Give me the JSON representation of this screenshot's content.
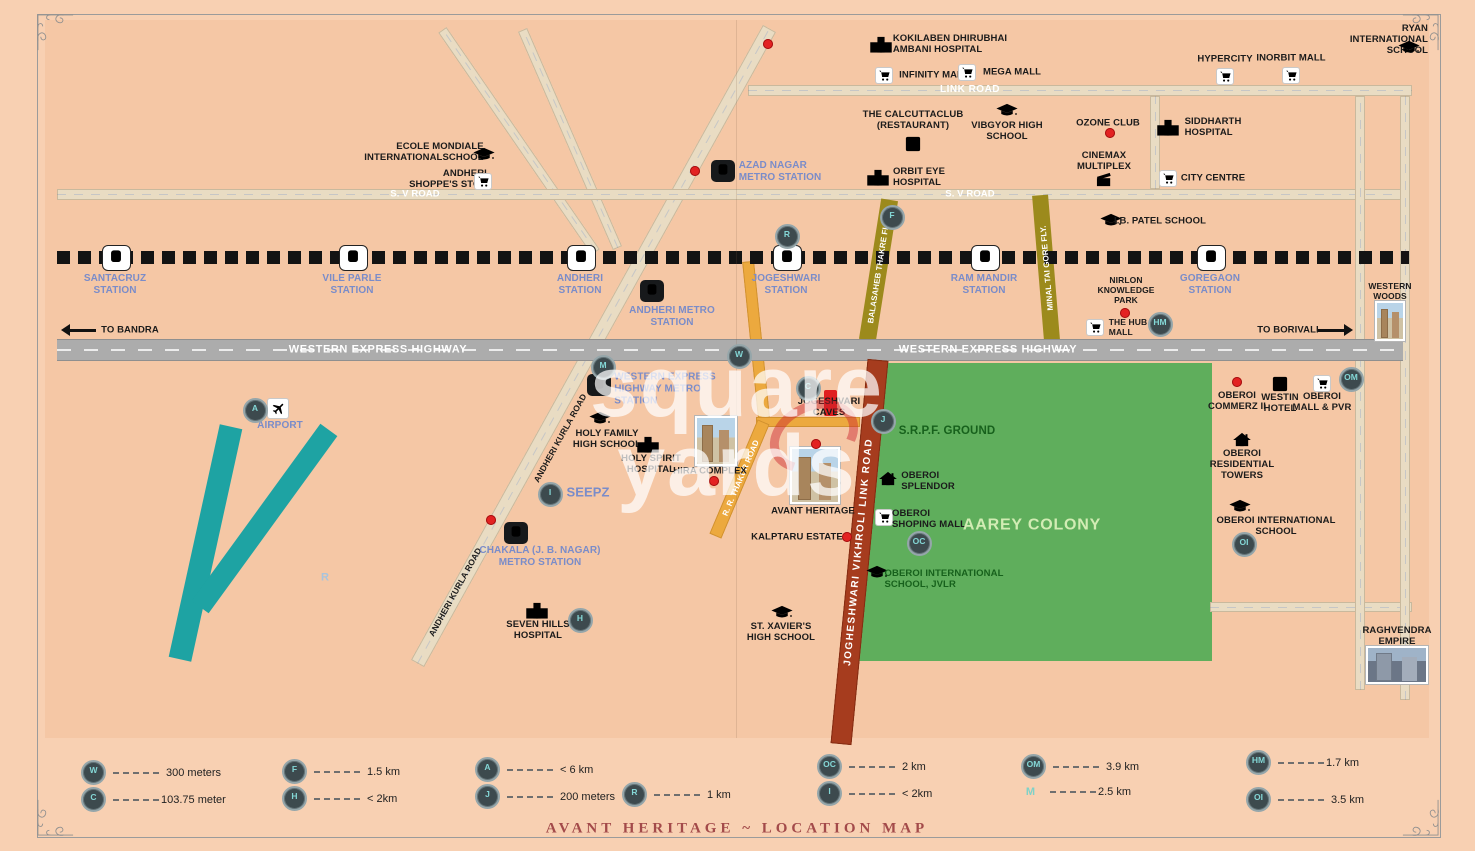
{
  "title": "AVANT HERITAGE ~ LOCATION MAP",
  "watermark": {
    "line1": "square",
    "line2": "yards"
  },
  "roads": {
    "link_road": "LINK ROAD",
    "sv_road_left": "S. V ROAD",
    "sv_road_right": "S. V ROAD",
    "weh_left": "WESTERN EXPRESS HIGHWAY",
    "weh_right": "WESTERN EXPRESS HIGHWAY",
    "balasaheb_fly": "BALASAHEB THAKRE FLY.",
    "minal_fly": "MINAL TAI GORE FLY.",
    "jvlr": "JOGHESHWARI VIKHROLI LINK ROAD",
    "rr_thakur": "R. R. THAKUR ROAD",
    "andheri_kurla_1": "ANDHERI KURLA ROAD",
    "andheri_kurla_2": "ANDHERI KURLA ROAD"
  },
  "labels": {
    "kokilaben": "KOKILABEN DHIRUBHAI\nAMBANI HOSPITAL",
    "infinity_mall": "INFINITY MALL",
    "mega_mall": "MEGA MALL",
    "hypercity": "HYPERCITY",
    "inorbit_mall": "INORBIT MALL",
    "ryan": "RYAN INTERNATIONAL\nSCHOOL",
    "calcutta_club": "THE CALCUTTACLUB\n(RESTAURANT)",
    "vibgyor": "VIBGYOR HIGH\nSCHOOL",
    "ozone_club": "OZONE CLUB",
    "cinemax": "CINEMAX\nMULTIPLEX",
    "siddharth": "SIDDHARTH\nHOSPITAL",
    "city_centre": "CITY CENTRE",
    "ecole": "ECOLE MONDIALE\nINTERNATIONALSCHOOL",
    "shoppes_stop": "ANDHERI\nSHOPPE'S STOP",
    "azad_nagar": "AZAD NAGAR\nMETRO STATION",
    "orbit_eye": "ORBIT EYE\nHOSPITAL",
    "ib_patel": "I.B. PATEL SCHOOL",
    "santacruz": "SANTACRUZ\nSTATION",
    "vile_parle": "VILE PARLE\nSTATION",
    "andheri_st": "ANDHERI\nSTATION",
    "jogeshwari_st": "JOGESHWARI\nSTATION",
    "ram_mandir_st": "RAM MANDIR\nSTATION",
    "goregaon_st": "GOREGAON\nSTATION",
    "andheri_metro": "ANDHERI METRO\nSTATION",
    "nirlon": "NIRLON\nKNOWLEDGE\nPARK",
    "hub_mall": "THE HUB\nMALL",
    "western_woods": "WESTERN\nWOODS",
    "to_bandra": "TO BANDRA",
    "to_borivali": "TO BORIVALI",
    "weh_metro": "WESTERN EXPRESS\nHIGHWAY METRO\nSTATION",
    "jogeshvari_caves": "JOGESHVARI\nCAVES",
    "srpf": "S.R.P.F. GROUND",
    "airport": "AIRPORT",
    "holy_family": "HOLY FAMILY\nHIGH SCHOOL",
    "holy_spirit": "HOLY SPIRIT\nHOSPITAL",
    "hira_complex": "HIRA COMPLEX",
    "avant_heritage": "AVANT HERITAGE",
    "oberoi_splendor": "OBEROI\nSPLENDOR",
    "oberoi_shoping": "OBEROI\nSHOPING MALL",
    "aarey": "AAREY COLONY",
    "kalptaru": "KALPTARU ESTATE",
    "oberoi_school_jvlr": "OBEROI INTERNATIONAL\nSCHOOL, JVLR",
    "seepz": "SEEPZ",
    "chakala": "CHAKALA (J. B. NAGAR)\nMETRO STATION",
    "seven_hills": "SEVEN HILLS\nHOSPITAL",
    "st_xavier": "ST. XAVIER'S\nHIGH SCHOOL",
    "r_area": "R",
    "oberoi_commerz": "OBEROI\nCOMMERZ II",
    "westin": "WESTIN\nHOTEL",
    "oberoi_mall_pvr": "OBEROI\nMALL & PVR",
    "oberoi_residential": "OBEROI\nRESIDENTIAL\nTOWERS",
    "oberoi_school": "OBEROI INTERNATIONAL\nSCHOOL",
    "raghvendra": "RAGHVENDRA\nEMPIRE"
  },
  "markers": {
    "w": "W",
    "c": "C",
    "f": "F",
    "h": "H",
    "a": "A",
    "j": "J",
    "r": "R",
    "oc": "OC",
    "i": "I",
    "om": "OM",
    "m": "M",
    "hm": "HM",
    "oi": "OI"
  },
  "legend": [
    {
      "key": "W",
      "value": "300 meters"
    },
    {
      "key": "C",
      "value": "103.75 meter"
    },
    {
      "key": "F",
      "value": "1.5 km"
    },
    {
      "key": "H",
      "value": "< 2km"
    },
    {
      "key": "A",
      "value": "< 6 km"
    },
    {
      "key": "J",
      "value": "200 meters"
    },
    {
      "key": "R",
      "value": "1 km"
    },
    {
      "key": "OC",
      "value": "2 km"
    },
    {
      "key": "I",
      "value": "< 2km"
    },
    {
      "key": "OM",
      "value": "3.9 km"
    },
    {
      "key": "M",
      "value": "2.5 km"
    },
    {
      "key": "HM",
      "value": "1.7 km"
    },
    {
      "key": "OI",
      "value": "3.5 km"
    }
  ],
  "icons": {
    "train-station-icon": "white box + black train",
    "metro-station-icon": "black box + white train",
    "shopping-cart-icon": "cart",
    "graduation-cap-icon": "cap",
    "hospital-icon": "building with cross",
    "house-icon": "house",
    "restaurant-icon": "plate in square",
    "cinema-icon": "clapperboard",
    "airplane-icon": "plane",
    "red-dot-marker": "red circle"
  },
  "colors": {
    "background": "#f5c7a5",
    "aarey_green": "#5fae5c",
    "highway_gray": "#acacac",
    "flyover_olive": "#9c8a1c",
    "jvlr_maroon": "#a63c1e",
    "orange_road": "#eca93e",
    "runway_teal": "#1ea3a3",
    "station_blue": "#7a8cc9",
    "marker_bg": "#3d4a4e",
    "marker_text": "#84d7d6",
    "red_marker": "#e32222",
    "title_red": "#a34a4a"
  }
}
